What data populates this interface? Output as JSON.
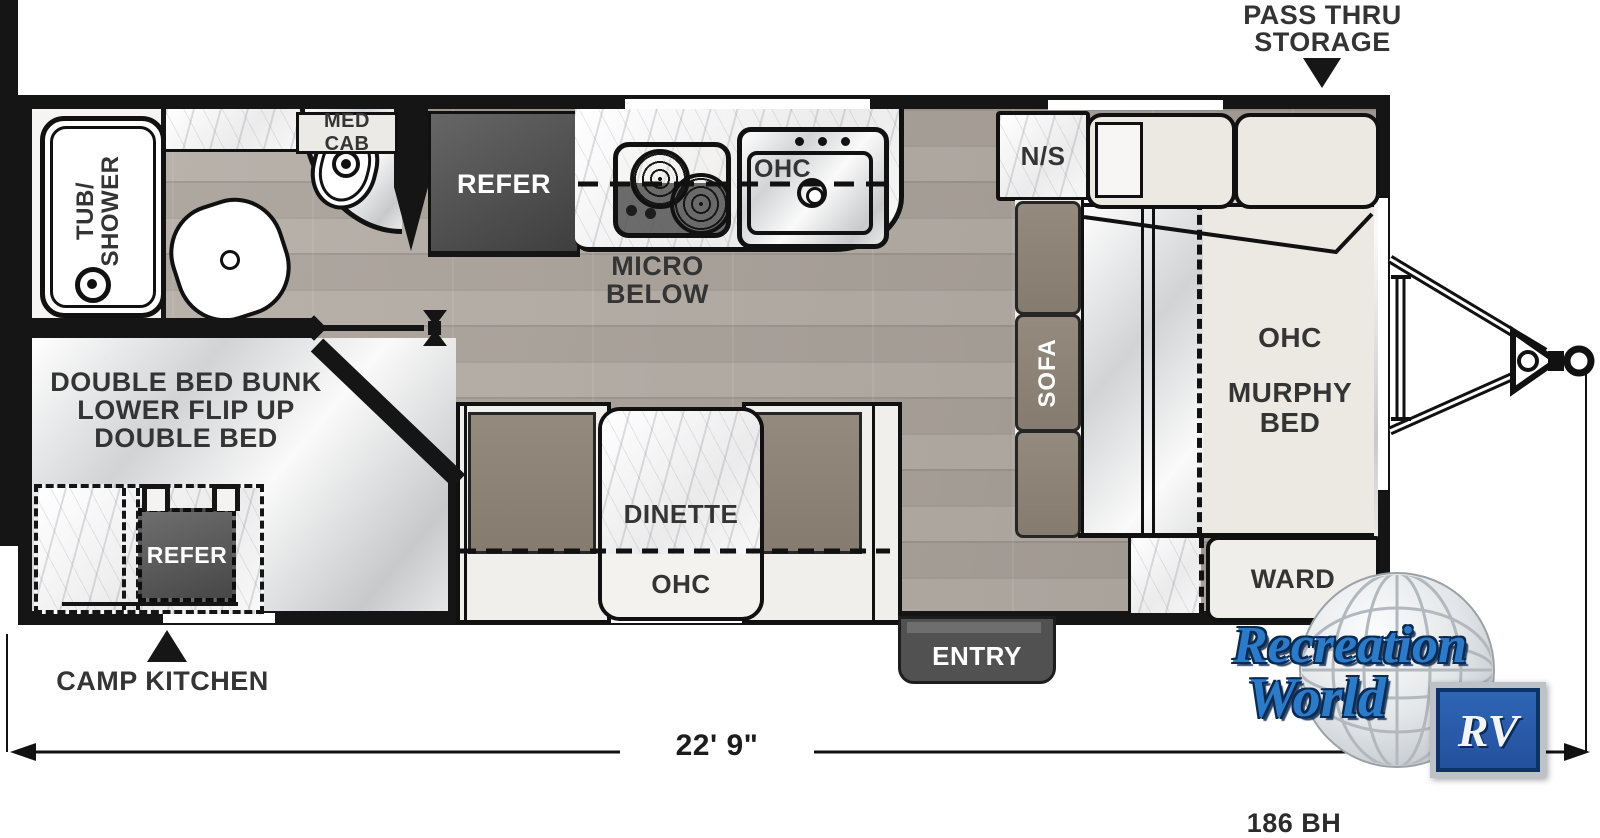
{
  "plan": {
    "model": "186 BH",
    "length_label": "22' 9\"",
    "pass_thru": {
      "line1": "PASS THRU",
      "line2": "STORAGE"
    },
    "camp_kitchen_label": "CAMP KITCHEN",
    "entry": "ENTRY",
    "bath": {
      "tub_line1": "TUB/",
      "tub_line2": "SHOWER",
      "med_cab": "MED CAB"
    },
    "kitchen": {
      "refer": "REFER",
      "ohc": "OHC",
      "micro_line1": "MICRO",
      "micro_line2": "BELOW"
    },
    "bunk": {
      "line1": "DOUBLE BED BUNK",
      "line2": "LOWER FLIP UP",
      "line3": "DOUBLE BED",
      "refer": "REFER"
    },
    "dinette": {
      "table": "DINETTE",
      "ohc": "OHC"
    },
    "bedroom": {
      "ns": "N/S",
      "sofa": "SOFA",
      "ohc": "OHC",
      "murphy_line1": "MURPHY",
      "murphy_line2": "BED",
      "ward": "WARD"
    },
    "logo": {
      "line1": "Recreation",
      "line2": "World",
      "badge": "RV"
    },
    "colors": {
      "wall": "#151515",
      "cushion": "#8d8377",
      "appliance_dark": "#4a4a4a",
      "bed_beige": "#ece9e2",
      "logo_blue": "#2b7bc9",
      "logo_navy": "#0c2f5e"
    }
  }
}
